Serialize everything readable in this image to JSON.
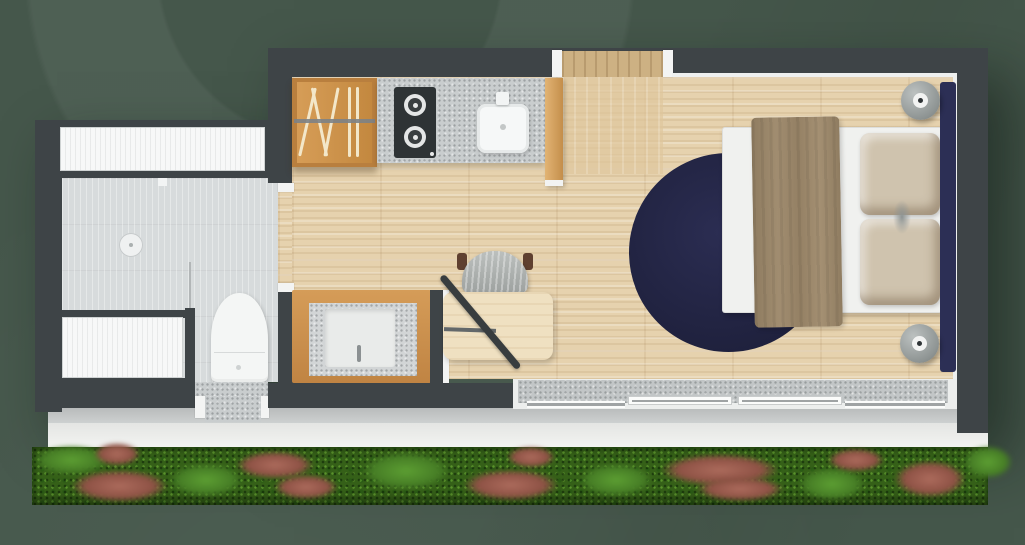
{
  "scene": {
    "type": "floor-plan-top-view",
    "subject": "studio tiny house unit with front garden hedge",
    "visible_text": ""
  },
  "palette": {
    "bg": "#45574b",
    "wall": "#3e4447",
    "woodFloor": "#e6d2ae",
    "tile": "#d7dbdc",
    "counter": "#c9cdce",
    "cabinetWood": "#cd9650",
    "stove": "#2e3335",
    "sinkWhite": "#f6f8f8",
    "rugNavy": "#222444",
    "headboardNavy": "#2c2f55",
    "mattress": "#f0f1ef",
    "blanket": "#c6b9a4",
    "pillow": "#cfc3ae",
    "chairGray": "#a8acab",
    "deskWood": "#efe0c1",
    "walkwayGray": "#c3c6c6",
    "walkwayWhite": "#f0f1ef",
    "hedgeGreen": "#477e26",
    "hedgeRed": "#8e5245"
  },
  "rooms": [
    {
      "name": "bathroom",
      "fixtures": [
        "shower-drain",
        "glass-divider",
        "toilet",
        "top-window",
        "side-window",
        "entry-mat"
      ]
    },
    {
      "name": "kitchen",
      "fixtures": [
        "rack-cabinet",
        "countertop",
        "two-burner-stove",
        "kitchen-sink",
        "tall-cabinet-panel"
      ]
    },
    {
      "name": "desk-nook",
      "fixtures": [
        "vanity-basin",
        "desk",
        "chair",
        "floor-lamp"
      ]
    },
    {
      "name": "bedroom",
      "fixtures": [
        "double-bed",
        "blanket",
        "pillows",
        "navy-headboard",
        "round-navy-rug",
        "bedside-cylinder-top",
        "bedside-cylinder-bottom"
      ]
    },
    {
      "name": "outdoor",
      "fixtures": [
        "entry-door-top",
        "sliding-glass-doors",
        "deck-strip",
        "walkway",
        "garden-hedge"
      ]
    }
  ]
}
